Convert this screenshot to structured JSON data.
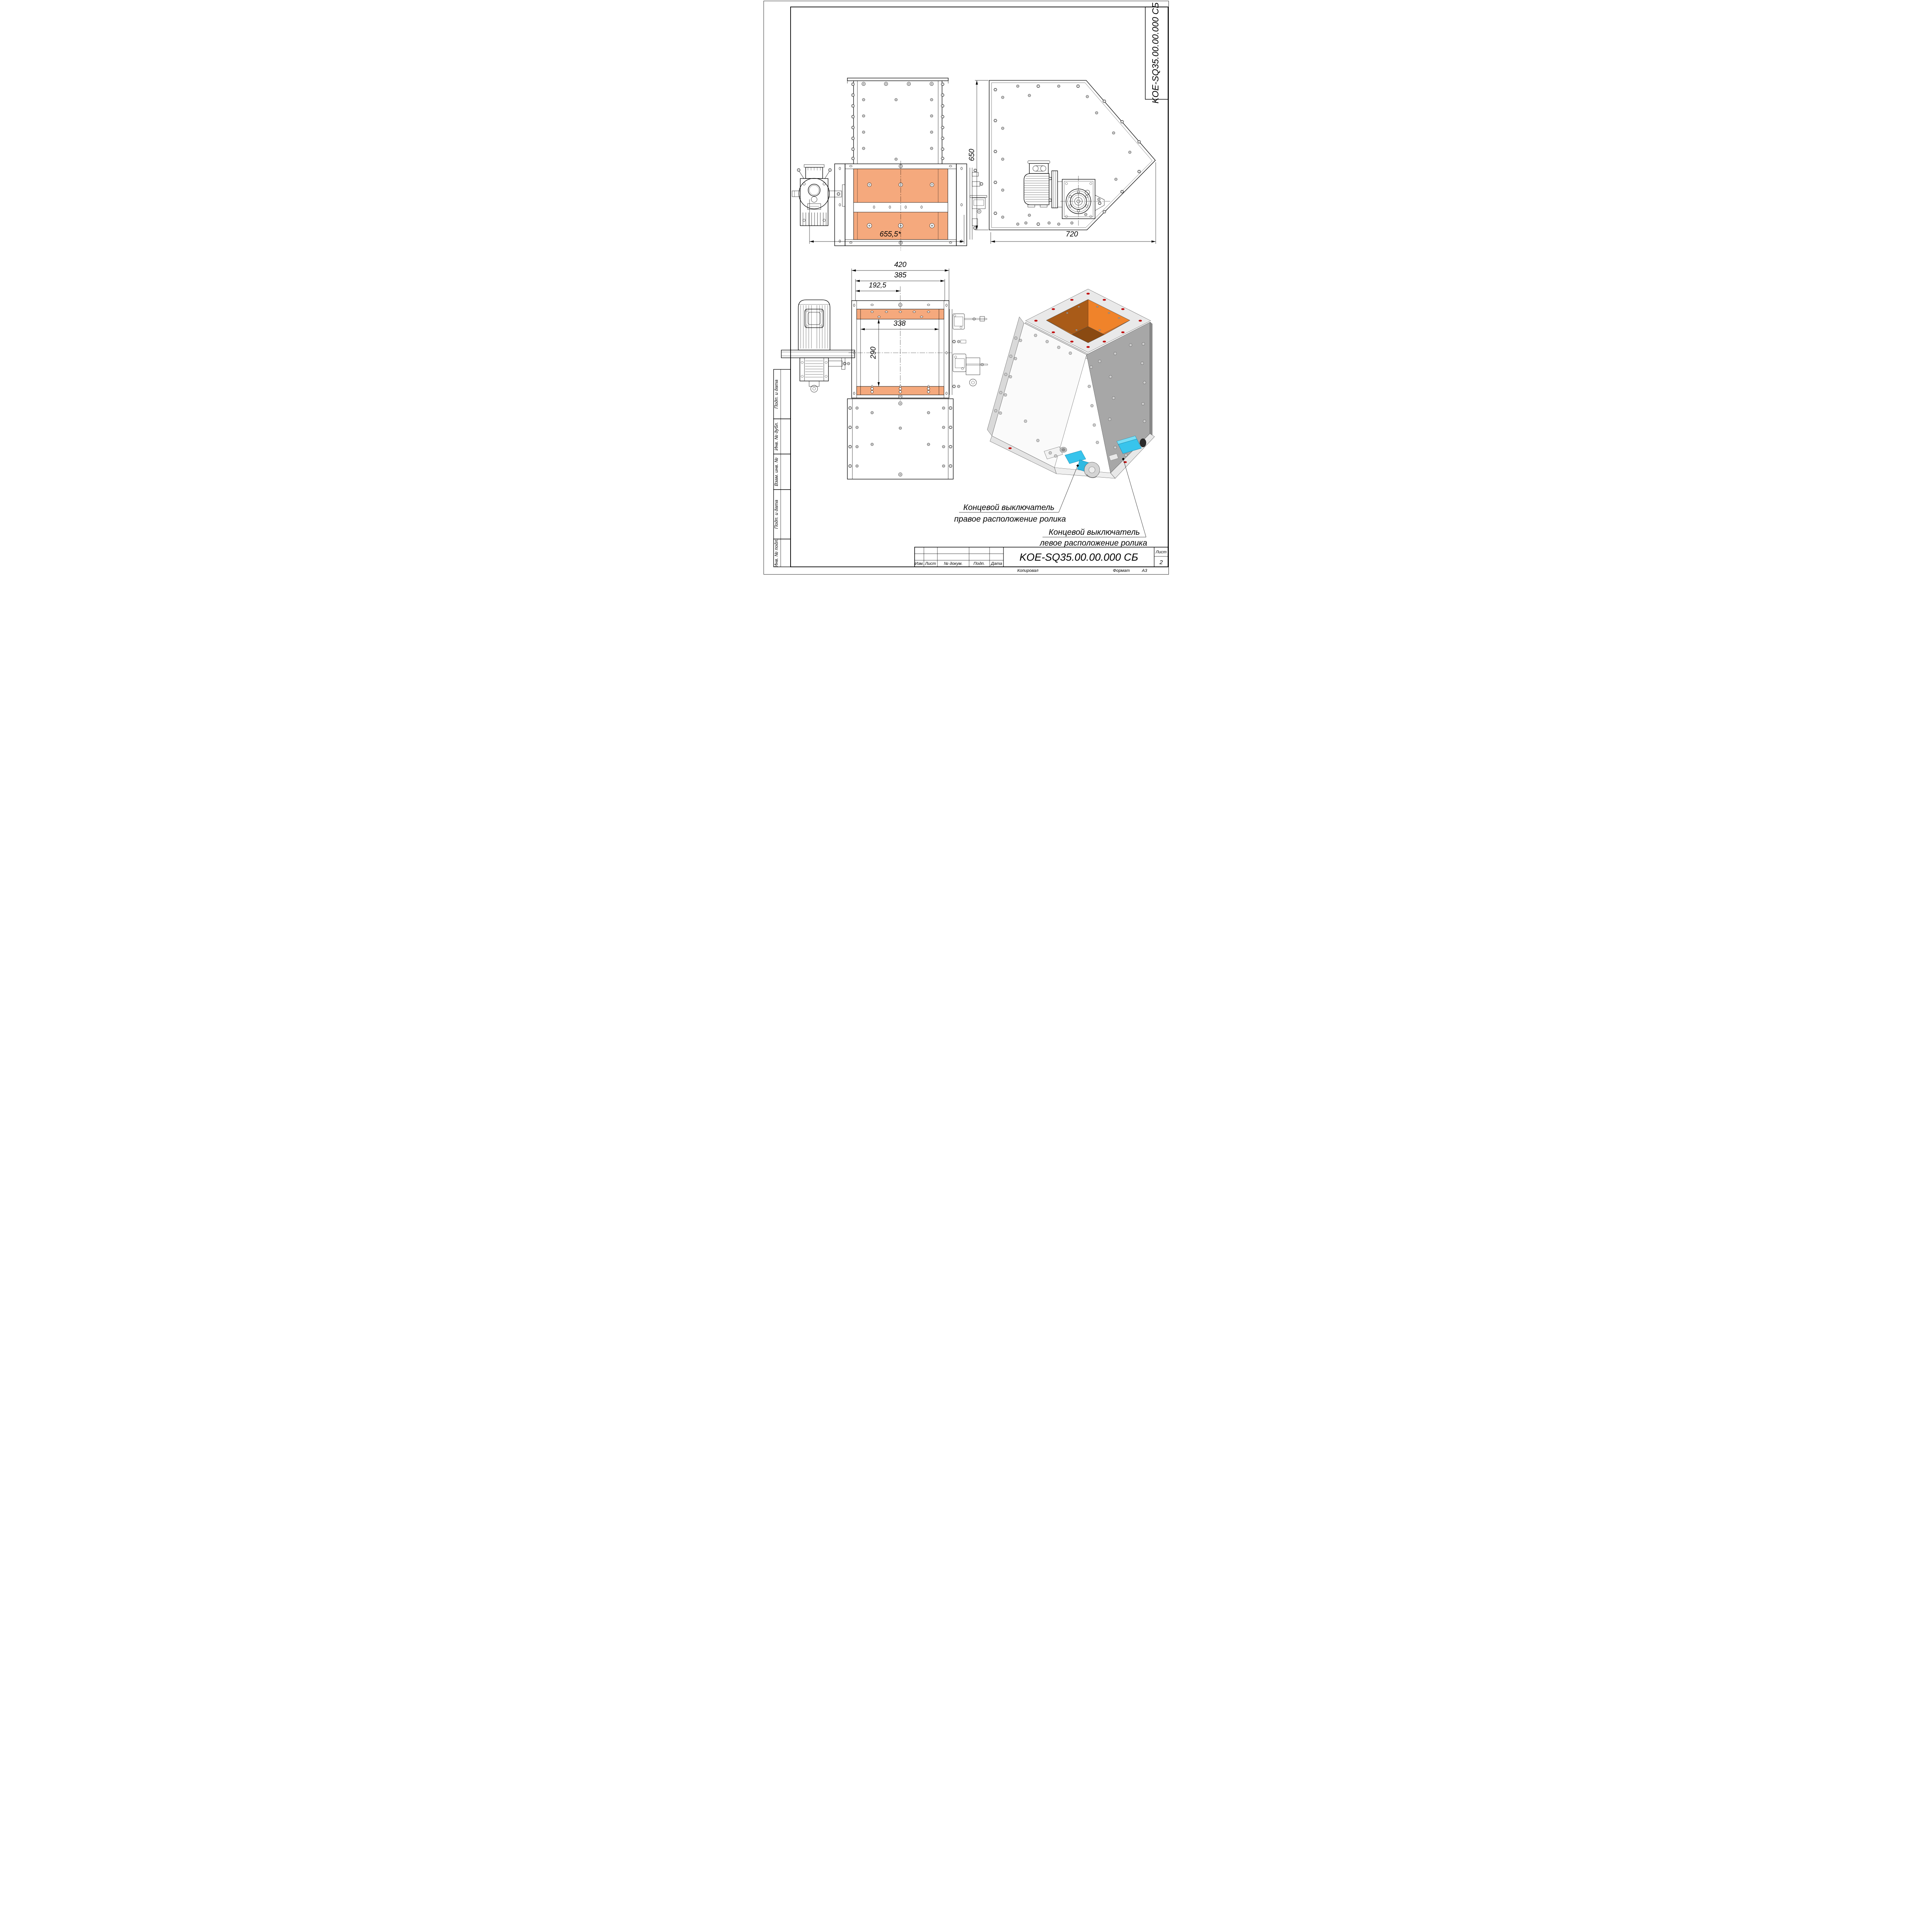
{
  "page": {
    "corner_designation": "KOE-SQ35.00.00.000 СБ"
  },
  "title_block": {
    "designation": "KOE-SQ35.00.00.000 СБ",
    "col_izm": "Изм.",
    "col_list": "Лист",
    "col_dokum": "№ докум.",
    "col_podp": "Подп.",
    "col_data": "Дата",
    "sheet_label": "Лист",
    "sheet_number": "2",
    "kopiroval": "Копировал",
    "format_label": "Формат",
    "format_value": "А3"
  },
  "margin_stamps": {
    "stamp1": "Подп. и дата",
    "stamp2": "Инв. № дубл.",
    "stamp3": "Взам. инв. №",
    "stamp4": "Подп. и дата",
    "stamp5": "Инв. № подл."
  },
  "dimensions": {
    "front_width": "655,5*",
    "side_height": "650",
    "side_width": "720",
    "plan_outer_width": "420",
    "plan_bolt_width": "385",
    "plan_half_width": "192,5",
    "plan_opening_width": "338",
    "plan_opening_height": "290"
  },
  "callouts": {
    "right_roller_line1": "Концевой выключатель",
    "right_roller_line2": "правое расположение ролика",
    "left_roller_line1": "Концевой выключатель",
    "left_roller_line2": "левое расположение ролика"
  },
  "colors": {
    "gate_panel_orange": "#F5A97D",
    "funnel_orange_bright": "#F0832A",
    "funnel_orange_dark": "#A95B18",
    "funnel_orange_mid": "#C96F1E",
    "funnel_throat": "#8A4A12",
    "switch_cyan": "#38C4EC",
    "switch_cyan_light": "#7ADEF5",
    "hole_red": "#C01010",
    "iso_wall_gray": "#A7A7A7",
    "iso_flange_light": "#E9E9E9",
    "iso_panel_white": "#FAFAFA"
  }
}
